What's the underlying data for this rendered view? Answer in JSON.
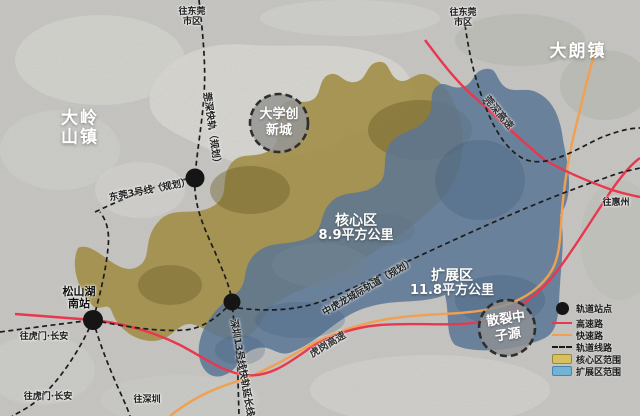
{
  "towns": {
    "dalingshan_l1": "大岭",
    "dalingshan_l2": "山镇",
    "dalang": "大朗镇"
  },
  "circles": {
    "university": {
      "line1": "大学创",
      "line2": "新城"
    },
    "neutron": {
      "line1": "散裂中",
      "line2": "子源"
    }
  },
  "zones": {
    "core": {
      "name": "核心区",
      "area": "8.9平方公里"
    },
    "extension": {
      "name": "扩展区",
      "area": "11.8平方公里"
    }
  },
  "stations": {
    "songshanhu_south_l1": "松山湖",
    "songshanhu_south_l2": "南站"
  },
  "rail_labels": {
    "guanshen_express_rail": "莞深快轨（规划）",
    "dongguan_line3": "东莞3号线（规划）",
    "zhonghulong_intercity": "中虎龙城际轨道（规划）",
    "shenzhen_line13_ext": "深圳13号线快轨延长线"
  },
  "road_labels": {
    "guanshen_expressway": "莞深高速",
    "hugang_expressway": "虎岗高速"
  },
  "directions": {
    "to_dongguan_nw_l1": "往东莞",
    "to_dongguan_nw_l2": "市区",
    "to_dongguan_ne_l1": "往东莞",
    "to_dongguan_ne_l2": "市区",
    "to_huizhou": "往惠州",
    "to_humen_changan_w": "往虎门·长安",
    "to_humen_changan_sw": "往虎门·长安",
    "to_shenzhen": "往深圳"
  },
  "legend": {
    "items": [
      {
        "label": "轨道站点",
        "type": "station"
      },
      {
        "label": "高速路",
        "type": "expressway",
        "color": "#e8374e"
      },
      {
        "label": "快速路",
        "type": "fastroad",
        "color": "#f0a050"
      },
      {
        "label": "轨道线路",
        "type": "rail-line"
      },
      {
        "label": "核心区范围",
        "type": "core-zone",
        "color": "#d6c160"
      },
      {
        "label": "扩展区范围",
        "type": "extension-zone",
        "color": "#72b2d4"
      }
    ]
  },
  "colors": {
    "expressway": "#e8374e",
    "fastroad": "#f0a050",
    "rail_line": "#1a1a1a",
    "core_zone": "#a08c44",
    "extension_zone": "#5a7694"
  }
}
